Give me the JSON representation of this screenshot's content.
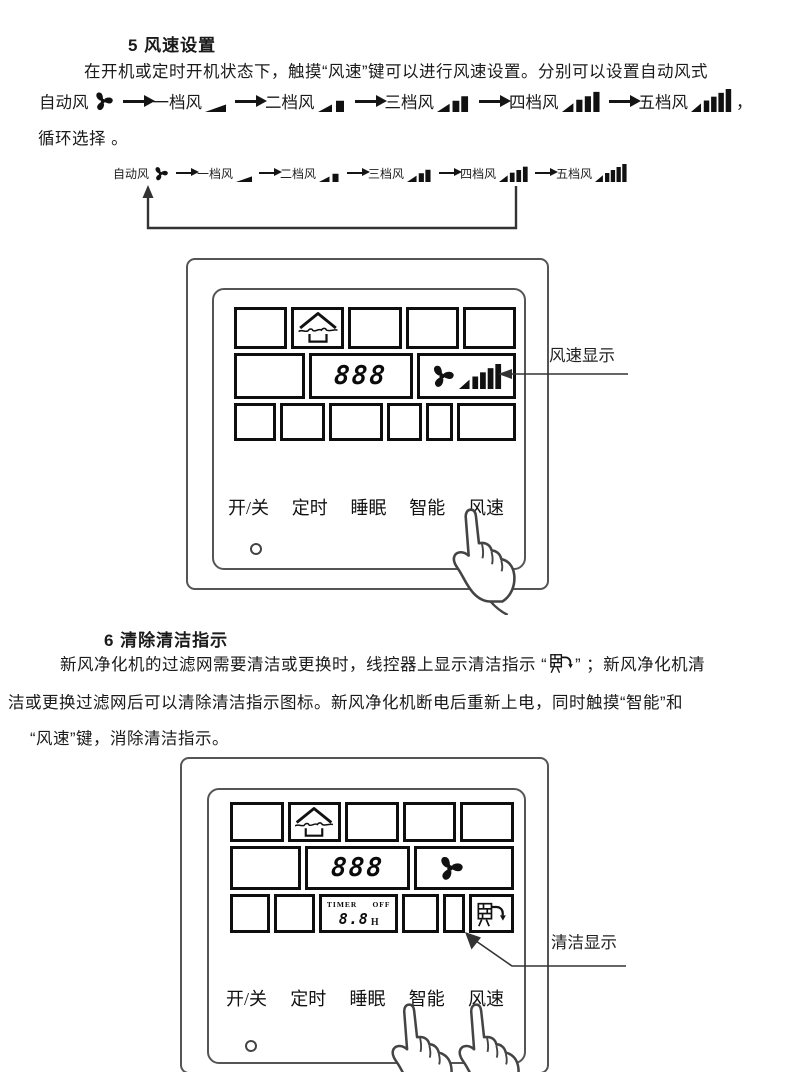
{
  "colors": {
    "ink": "#1a1a1a",
    "drawing_line": "#444444",
    "lcd_border": "#0e0e0e"
  },
  "section5": {
    "heading": "5 风速设置",
    "para_line1": "在开机或定时开机状态下，触摸“风速”键可以进行风速设置。分别可以设置自动风式",
    "comma": "，",
    "para_line2": "循环选择 。"
  },
  "fan_sequence": {
    "labels": [
      "自动风",
      "一档风",
      "二档风",
      "三档风",
      "四档风",
      "五档风"
    ]
  },
  "panel": {
    "display_value": "888",
    "buttons": [
      "开/关",
      "定时",
      "睡眠",
      "智能",
      "风速"
    ]
  },
  "timer": {
    "label": "TIMER",
    "state": "OFF",
    "value": "8.8",
    "unit": "H"
  },
  "callouts": {
    "speed": "风速显示",
    "clean": "清洁显示"
  },
  "section6": {
    "heading": "6 清除清洁指示",
    "para_line1_pre": "新风净化机的过滤网需要清洁或更换时，线控器上显示清洁指示 “",
    "para_line1_post": "” ；新风净化机清",
    "para_line2": "洁或更换过滤网后可以清除清洁指示图标。新风净化机断电后重新上电，同时触摸“智能”和",
    "para_line3": "“风速”键，消除清洁指示。"
  }
}
